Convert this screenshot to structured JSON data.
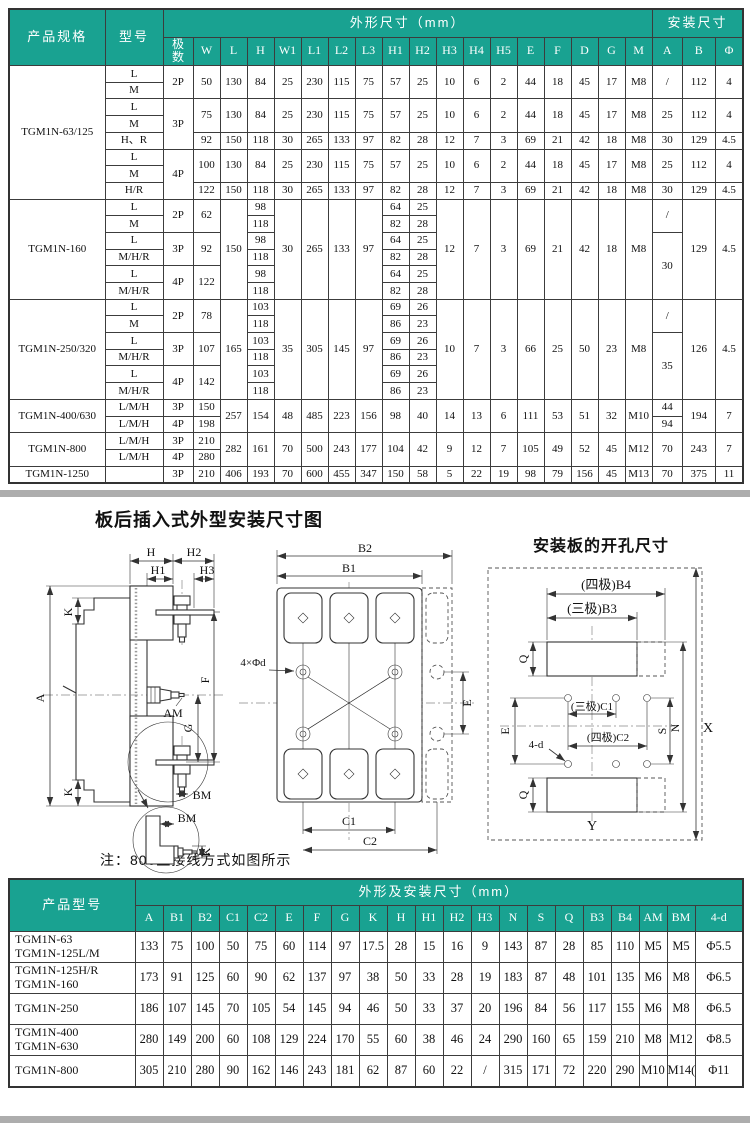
{
  "colors": {
    "header_bg": "#19a291",
    "divider": "#adadad",
    "border": "#3c3c3c"
  },
  "top_table": {
    "header": [
      [
        [
          "产品规格",
          2,
          1,
          "hbig"
        ],
        [
          "型号",
          2,
          1,
          "hbig"
        ],
        [
          "外形尺寸（mm）",
          1,
          18,
          "hbig"
        ],
        [
          "安装尺寸",
          1,
          3,
          "hbig"
        ]
      ],
      [
        [
          "极\n数"
        ],
        [
          "W"
        ],
        [
          "L"
        ],
        [
          "H"
        ],
        [
          "W1"
        ],
        [
          "L1"
        ],
        [
          "L2"
        ],
        [
          "L3"
        ],
        [
          "H1"
        ],
        [
          "H2"
        ],
        [
          "H3"
        ],
        [
          "H4"
        ],
        [
          "H5"
        ],
        [
          "E"
        ],
        [
          "F"
        ],
        [
          "D"
        ],
        [
          "G"
        ],
        [
          "M"
        ],
        [
          "A"
        ],
        [
          "B"
        ],
        [
          "Φ"
        ]
      ]
    ],
    "rows": [
      [
        [
          "TGM1N-63/125",
          8
        ],
        "L",
        [
          "2P",
          2
        ],
        [
          "50",
          2
        ],
        [
          "130",
          2
        ],
        [
          "84",
          2
        ],
        [
          "25",
          2
        ],
        [
          "230",
          2
        ],
        [
          "115",
          2
        ],
        [
          "75",
          2
        ],
        [
          "57",
          2
        ],
        [
          "25",
          2
        ],
        [
          "10",
          2
        ],
        [
          "6",
          2
        ],
        [
          "2",
          2
        ],
        [
          "44",
          2
        ],
        [
          "18",
          2
        ],
        [
          "45",
          2
        ],
        [
          "17",
          2
        ],
        [
          "M8",
          2
        ],
        [
          "/",
          2
        ],
        [
          "112",
          2
        ],
        [
          "4",
          2
        ]
      ],
      [
        "M"
      ],
      [
        "L",
        [
          "3P",
          3
        ],
        [
          "75",
          2
        ],
        [
          "130",
          2
        ],
        [
          "84",
          2
        ],
        [
          "25",
          2
        ],
        [
          "230",
          2
        ],
        [
          "115",
          2
        ],
        [
          "75",
          2
        ],
        [
          "57",
          2
        ],
        [
          "25",
          2
        ],
        [
          "10",
          2
        ],
        [
          "6",
          2
        ],
        [
          "2",
          2
        ],
        [
          "44",
          2
        ],
        [
          "18",
          2
        ],
        [
          "45",
          2
        ],
        [
          "17",
          2
        ],
        [
          "M8",
          2
        ],
        [
          "25",
          2
        ],
        [
          "112",
          2
        ],
        [
          "4",
          2
        ]
      ],
      [
        "M"
      ],
      [
        "H、R",
        "92",
        "150",
        "118",
        "30",
        "265",
        "133",
        "97",
        "82",
        "28",
        "12",
        "7",
        "3",
        "69",
        "21",
        "42",
        "18",
        "M8",
        "30",
        "129",
        "4.5"
      ],
      [
        "L",
        [
          "4P",
          3
        ],
        [
          "100",
          2
        ],
        [
          "130",
          2
        ],
        [
          "84",
          2
        ],
        [
          "25",
          2
        ],
        [
          "230",
          2
        ],
        [
          "115",
          2
        ],
        [
          "75",
          2
        ],
        [
          "57",
          2
        ],
        [
          "25",
          2
        ],
        [
          "10",
          2
        ],
        [
          "6",
          2
        ],
        [
          "2",
          2
        ],
        [
          "44",
          2
        ],
        [
          "18",
          2
        ],
        [
          "45",
          2
        ],
        [
          "17",
          2
        ],
        [
          "M8",
          2
        ],
        [
          "25",
          2
        ],
        [
          "112",
          2
        ],
        [
          "4",
          2
        ]
      ],
      [
        "M"
      ],
      [
        "H/R",
        "122",
        "150",
        "118",
        "30",
        "265",
        "133",
        "97",
        "82",
        "28",
        "12",
        "7",
        "3",
        "69",
        "21",
        "42",
        "18",
        "M8",
        "30",
        "129",
        "4.5"
      ],
      [
        [
          "TGM1N-160",
          6
        ],
        "L",
        [
          "2P",
          2
        ],
        [
          "62",
          2
        ],
        [
          "150",
          6
        ],
        "98",
        [
          "30",
          6
        ],
        [
          "265",
          6
        ],
        [
          "133",
          6
        ],
        [
          "97",
          6
        ],
        "64",
        "25",
        [
          "12",
          6
        ],
        [
          "7",
          6
        ],
        [
          "3",
          6
        ],
        [
          "69",
          6
        ],
        [
          "21",
          6
        ],
        [
          "42",
          6
        ],
        [
          "18",
          6
        ],
        [
          "M8",
          6
        ],
        [
          "/",
          2
        ],
        [
          "129",
          6
        ],
        [
          "4.5",
          6
        ]
      ],
      [
        "M",
        "118",
        "82",
        "28"
      ],
      [
        "L",
        [
          "3P",
          2
        ],
        [
          "92",
          2
        ],
        "98",
        "64",
        "25",
        [
          "30",
          4
        ]
      ],
      [
        "M/H/R",
        "118",
        "82",
        "28"
      ],
      [
        "L",
        [
          "4P",
          2
        ],
        [
          "122",
          2
        ],
        "98",
        "64",
        "25"
      ],
      [
        "M/H/R",
        "118",
        "82",
        "28"
      ],
      [
        [
          "TGM1N-250/320",
          6
        ],
        "L",
        [
          "2P",
          2
        ],
        [
          "78",
          2
        ],
        [
          "165",
          6
        ],
        "103",
        [
          "35",
          6
        ],
        [
          "305",
          6
        ],
        [
          "145",
          6
        ],
        [
          "97",
          6
        ],
        "69",
        "26",
        [
          "10",
          6
        ],
        [
          "7",
          6
        ],
        [
          "3",
          6
        ],
        [
          "66",
          6
        ],
        [
          "25",
          6
        ],
        [
          "50",
          6
        ],
        [
          "23",
          6
        ],
        [
          "M8",
          6
        ],
        [
          "/",
          2
        ],
        [
          "126",
          6
        ],
        [
          "4.5",
          6
        ]
      ],
      [
        "M",
        "118",
        "86",
        "23"
      ],
      [
        "L",
        [
          "3P",
          2
        ],
        [
          "107",
          2
        ],
        "103",
        "69",
        "26",
        [
          "35",
          4
        ]
      ],
      [
        "M/H/R",
        "118",
        "86",
        "23"
      ],
      [
        "L",
        [
          "4P",
          2
        ],
        [
          "142",
          2
        ],
        "103",
        "69",
        "26"
      ],
      [
        "M/H/R",
        "118",
        "86",
        "23"
      ],
      [
        [
          "TGM1N-400/630",
          2
        ],
        "L/M/H",
        "3P",
        "150",
        [
          "257",
          2
        ],
        [
          "154",
          2
        ],
        [
          "48",
          2
        ],
        [
          "485",
          2
        ],
        [
          "223",
          2
        ],
        [
          "156",
          2
        ],
        [
          "98",
          2
        ],
        [
          "40",
          2
        ],
        [
          "14",
          2
        ],
        [
          "13",
          2
        ],
        [
          "6",
          2
        ],
        [
          "111",
          2
        ],
        [
          "53",
          2
        ],
        [
          "51",
          2
        ],
        [
          "32",
          2
        ],
        [
          "M10",
          2
        ],
        "44",
        [
          "194",
          2
        ],
        [
          "7",
          2
        ]
      ],
      [
        "L/M/H",
        "4P",
        "198",
        "94"
      ],
      [
        [
          "TGM1N-800",
          2
        ],
        "L/M/H",
        "3P",
        "210",
        [
          "282",
          2
        ],
        [
          "161",
          2
        ],
        [
          "70",
          2
        ],
        [
          "500",
          2
        ],
        [
          "243",
          2
        ],
        [
          "177",
          2
        ],
        [
          "104",
          2
        ],
        [
          "42",
          2
        ],
        [
          "9",
          2
        ],
        [
          "12",
          2
        ],
        [
          "7",
          2
        ],
        [
          "105",
          2
        ],
        [
          "49",
          2
        ],
        [
          "52",
          2
        ],
        [
          "45",
          2
        ],
        [
          "M12",
          2
        ],
        [
          "70",
          2
        ],
        [
          "243",
          2
        ],
        [
          "7",
          2
        ]
      ],
      [
        "L/M/H",
        "4P",
        "280"
      ],
      [
        "TGM1N-1250",
        "",
        "3P",
        "210",
        "406",
        "193",
        "70",
        "600",
        "455",
        "347",
        "150",
        "58",
        "5",
        "22",
        "19",
        "98",
        "79",
        "156",
        "45",
        "M13",
        "70",
        "375",
        "11"
      ]
    ]
  },
  "bottom_table": {
    "header": [
      [
        [
          "产品型号",
          2,
          1,
          "hbig"
        ],
        [
          "外形及安装尺寸（mm）",
          1,
          21,
          "hbig"
        ]
      ],
      [
        [
          "A"
        ],
        [
          "B1"
        ],
        [
          "B2"
        ],
        [
          "C1"
        ],
        [
          "C2"
        ],
        [
          "E"
        ],
        [
          "F"
        ],
        [
          "G"
        ],
        [
          "K"
        ],
        [
          "H"
        ],
        [
          "H1"
        ],
        [
          "H2"
        ],
        [
          "H3"
        ],
        [
          "N"
        ],
        [
          "S"
        ],
        [
          "Q"
        ],
        [
          "B3"
        ],
        [
          "B4"
        ],
        [
          "AM"
        ],
        [
          "BM"
        ],
        [
          "4-d"
        ]
      ]
    ],
    "rows": [
      [
        [
          "TGM1N-63\nTGM1N-125L/M",
          1,
          1,
          "model"
        ],
        "133",
        "75",
        "100",
        "50",
        "75",
        "60",
        "114",
        "97",
        "17.5",
        "28",
        "15",
        "16",
        "9",
        "143",
        "87",
        "28",
        "85",
        "110",
        "M5",
        "M5",
        "Φ5.5"
      ],
      [
        [
          "TGM1N-125H/R\nTGM1N-160",
          1,
          1,
          "model"
        ],
        "173",
        "91",
        "125",
        "60",
        "90",
        "62",
        "137",
        "97",
        "38",
        "50",
        "33",
        "28",
        "19",
        "183",
        "87",
        "48",
        "101",
        "135",
        "M6",
        "M8",
        "Φ6.5"
      ],
      [
        [
          "TGM1N-250",
          1,
          1,
          "model"
        ],
        "186",
        "107",
        "145",
        "70",
        "105",
        "54",
        "145",
        "94",
        "46",
        "50",
        "33",
        "37",
        "20",
        "196",
        "84",
        "56",
        "117",
        "155",
        "M6",
        "M8",
        "Φ6.5"
      ],
      [
        [
          "TGM1N-400\nTGM1N-630",
          1,
          1,
          "model"
        ],
        "280",
        "149",
        "200",
        "60",
        "108",
        "129",
        "224",
        "170",
        "55",
        "60",
        "38",
        "46",
        "24",
        "290",
        "160",
        "65",
        "159",
        "210",
        "M8",
        "M12",
        "Φ8.5"
      ],
      [
        [
          "TGM1N-800",
          1,
          1,
          "model"
        ],
        "305",
        "210",
        "280",
        "90",
        "162",
        "146",
        "243",
        "181",
        "62",
        "87",
        "60",
        "22",
        "/",
        "315",
        "171",
        "72",
        "220",
        "290",
        "M10",
        "M14(T)",
        "Φ11"
      ]
    ]
  },
  "diagram": {
    "section_title": "板后插入式外型安装尺寸图",
    "holes_title": "安装板的开孔尺寸",
    "note": "注：800型接线方式如图所示",
    "side_labels": {
      "H": "H",
      "H1": "H1",
      "H2": "H2",
      "H3": "H3",
      "K": "K",
      "A": "A",
      "AM": "AM",
      "G": "G",
      "F": "F",
      "BM": "BM"
    },
    "front_labels": {
      "B1": "B1",
      "B2": "B2",
      "C1": "C1",
      "C2": "C2",
      "E": "E",
      "holes": "4×Φd"
    },
    "plate_labels": {
      "B4": "(四极)B4",
      "B3": "(三极)B3",
      "C1": "(三极)C1",
      "C2": "(四极)C2",
      "Q": "Q",
      "E": "E",
      "S": "S",
      "N": "N",
      "X": "X",
      "Y": "Y",
      "d": "4-d"
    }
  }
}
